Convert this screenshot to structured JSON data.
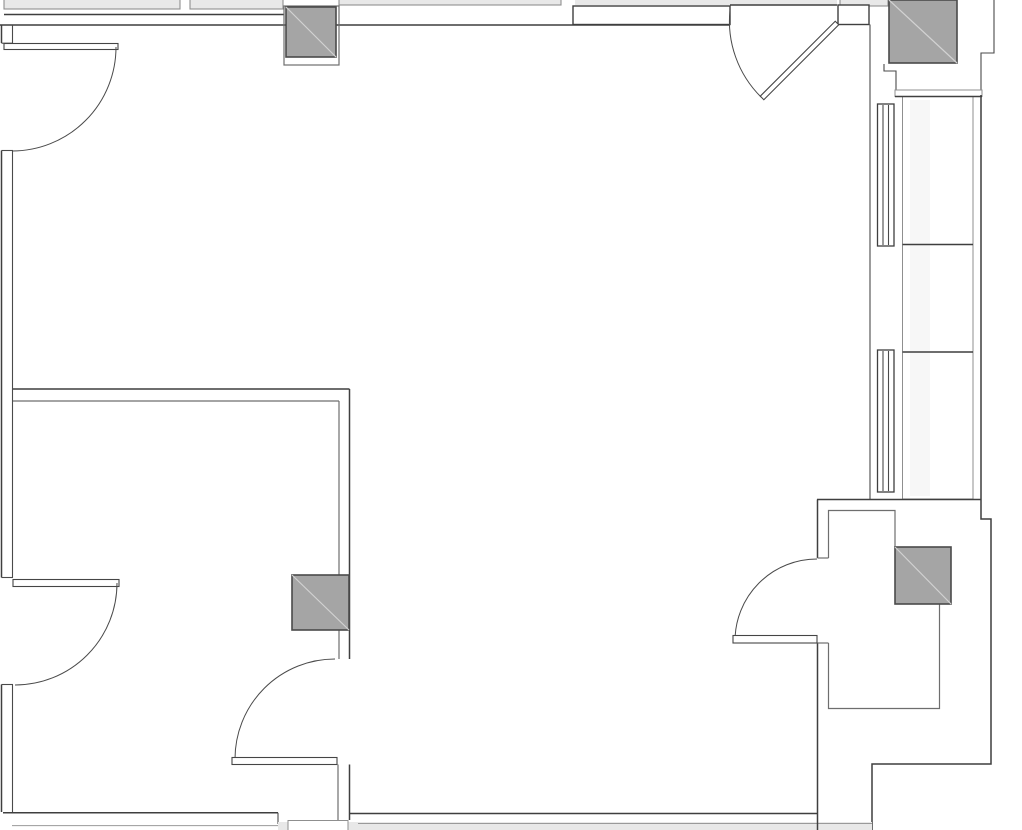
{
  "drawing": {
    "kind": "architectural floor plan (no text labels visible)",
    "canvas": {
      "width": 1022,
      "height": 830
    }
  },
  "colors": {
    "background": "#ffffff",
    "wall_line": "#3f3f3f",
    "wall_line_mid": "#6e6e6e",
    "wall_line_light": "#9a9a9a",
    "column_fill": "#a5a5a5",
    "column_outline": "#4a4a4a",
    "column_diagonal": "#d2d2d2",
    "band_fill": "#e8e8e8",
    "faint_strip_fill": "#f7f7f7",
    "white_fill": "#ffffff"
  },
  "inventory": {
    "structural_columns": [
      {
        "id": "column-top-middle",
        "x": 286,
        "y": 7,
        "w": 50,
        "h": 50
      },
      {
        "id": "column-top-right",
        "x": 889,
        "y": 0,
        "w": 68,
        "h": 63
      },
      {
        "id": "column-mid-left-wall",
        "x": 292,
        "y": 575,
        "w": 57,
        "h": 55
      },
      {
        "id": "column-vestibule",
        "x": 895,
        "y": 547,
        "w": 56,
        "h": 57
      }
    ],
    "doors": [
      {
        "id": "door-left-upper",
        "swing": "quarter-arc, hinged top of left wall"
      },
      {
        "id": "door-left-lower",
        "swing": "quarter-arc, hinged on left wall"
      },
      {
        "id": "door-top-right",
        "swing": "partially open 45-degree leaf in top wall"
      },
      {
        "id": "door-inner-room",
        "swing": "quarter-arc, hinged bottom of inner wall"
      },
      {
        "id": "door-vestibule",
        "swing": "quarter-arc, hinged on vestibule wall"
      }
    ],
    "windows": [
      {
        "id": "window-mullion-upper",
        "x": 877,
        "y": 104,
        "w": 17,
        "h": 142
      },
      {
        "id": "window-mullion-lower",
        "x": 877,
        "y": 350,
        "w": 17,
        "h": 142
      }
    ]
  }
}
